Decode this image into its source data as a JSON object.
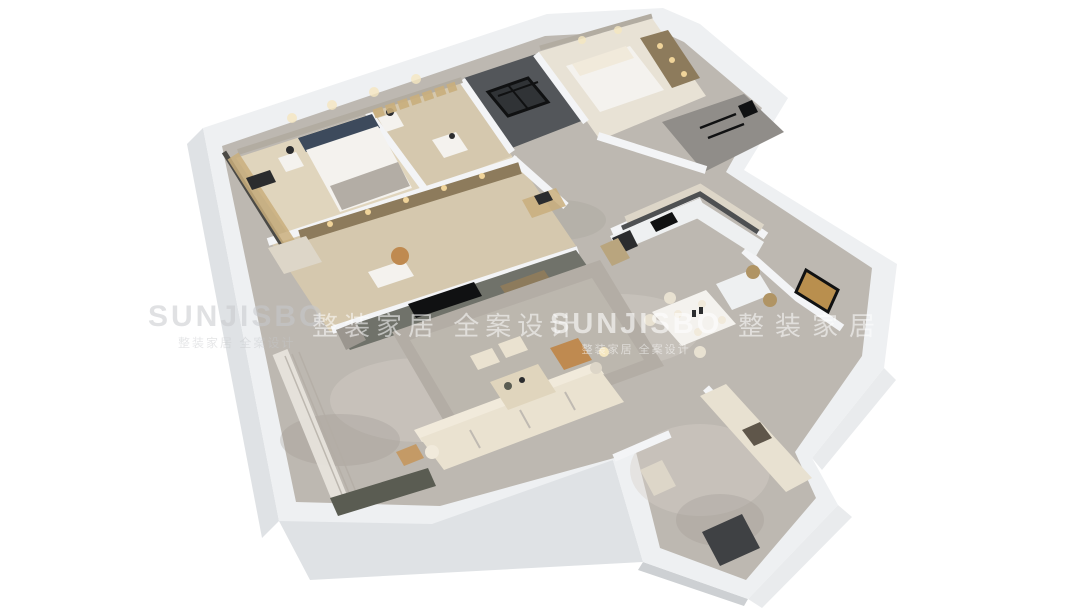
{
  "scene": {
    "type": "isometric-3d-floorplan-render",
    "background": "#ffffff"
  },
  "watermark": {
    "items": [
      {
        "text": "SUNJISBO"
      },
      {
        "text": "整装家居 全案设计"
      },
      {
        "text": "SUNJISBO"
      },
      {
        "text": "整装家居 全案设计"
      }
    ],
    "tagline": "整装家居 全案设计"
  },
  "palette": {
    "bg": "#ffffff",
    "wallTop": "#eef0f2",
    "wallFace": "#cdd0d3",
    "wallFaceLight": "#dfe2e5",
    "wallFaceWhite": "#e9ebed",
    "wallWarm": "#b2aca1",
    "marble": "#bdb8b1",
    "marbleLight": "#d6d1ca",
    "marbleDark": "#9b968f",
    "stoneGray": "#908d89",
    "wood": "#d5c8ae",
    "woodLight": "#e0d5bd",
    "carpet": "#e8e2d5",
    "rug": "#b3ada5",
    "rugLight": "#c0bab2",
    "sofa": "#eae2d0",
    "sofaBack": "#f1eadb",
    "cream": "#e8e1d1",
    "tan": "#bf8a50",
    "tanLight": "#c49a66",
    "rattan": "#b09464",
    "navy": "#3d4a5c",
    "dark": "#2b2c2e",
    "black": "#101112",
    "charcoal": "#4e5052",
    "darkRoom": "#53565a",
    "darkFrame": "#303336",
    "olive": "#70726a",
    "oliveDark": "#5a5c52",
    "shelfWood": "#8d7b5c",
    "shelfLit": "#f0d49a",
    "gold": "#c9ae7c",
    "goldArt": "#b98f4e",
    "white": "#f4f2ee",
    "counter": "#eef0f1",
    "cabinet": "#ddd6c8",
    "fridgeWood": "#b9a57e",
    "nicheDark": "#5f564a",
    "doorDark": "#3f4144",
    "glassDark": "#4b4a46",
    "curtain": "#e9e6df",
    "partition": "#f3f4f6",
    "glow": "#f5e7c0"
  },
  "rooms": [
    {
      "name": "master-bedroom"
    },
    {
      "name": "walk-in-closet"
    },
    {
      "name": "shower-room"
    },
    {
      "name": "bedroom-2"
    },
    {
      "name": "bathroom"
    },
    {
      "name": "study"
    },
    {
      "name": "hallway"
    },
    {
      "name": "kitchen"
    },
    {
      "name": "dining-area"
    },
    {
      "name": "art-room"
    },
    {
      "name": "living-room"
    },
    {
      "name": "balcony"
    },
    {
      "name": "entry-hall"
    }
  ],
  "furniture": [
    {
      "name": "master-bed"
    },
    {
      "name": "nightstands"
    },
    {
      "name": "wardrobe"
    },
    {
      "name": "vanity"
    },
    {
      "name": "guest-bed"
    },
    {
      "name": "bookshelf"
    },
    {
      "name": "desk"
    },
    {
      "name": "office-chair"
    },
    {
      "name": "media-wall-tv"
    },
    {
      "name": "kitchen-counter"
    },
    {
      "name": "cooktop"
    },
    {
      "name": "oven-column"
    },
    {
      "name": "dining-table"
    },
    {
      "name": "dining-chairs"
    },
    {
      "name": "island"
    },
    {
      "name": "sofa"
    },
    {
      "name": "coffee-table"
    },
    {
      "name": "ottomans"
    },
    {
      "name": "armchair"
    },
    {
      "name": "floor-lamp"
    },
    {
      "name": "rug"
    },
    {
      "name": "wall-art"
    },
    {
      "name": "entry-cabinets"
    },
    {
      "name": "entrance-door"
    },
    {
      "name": "curtains"
    }
  ]
}
